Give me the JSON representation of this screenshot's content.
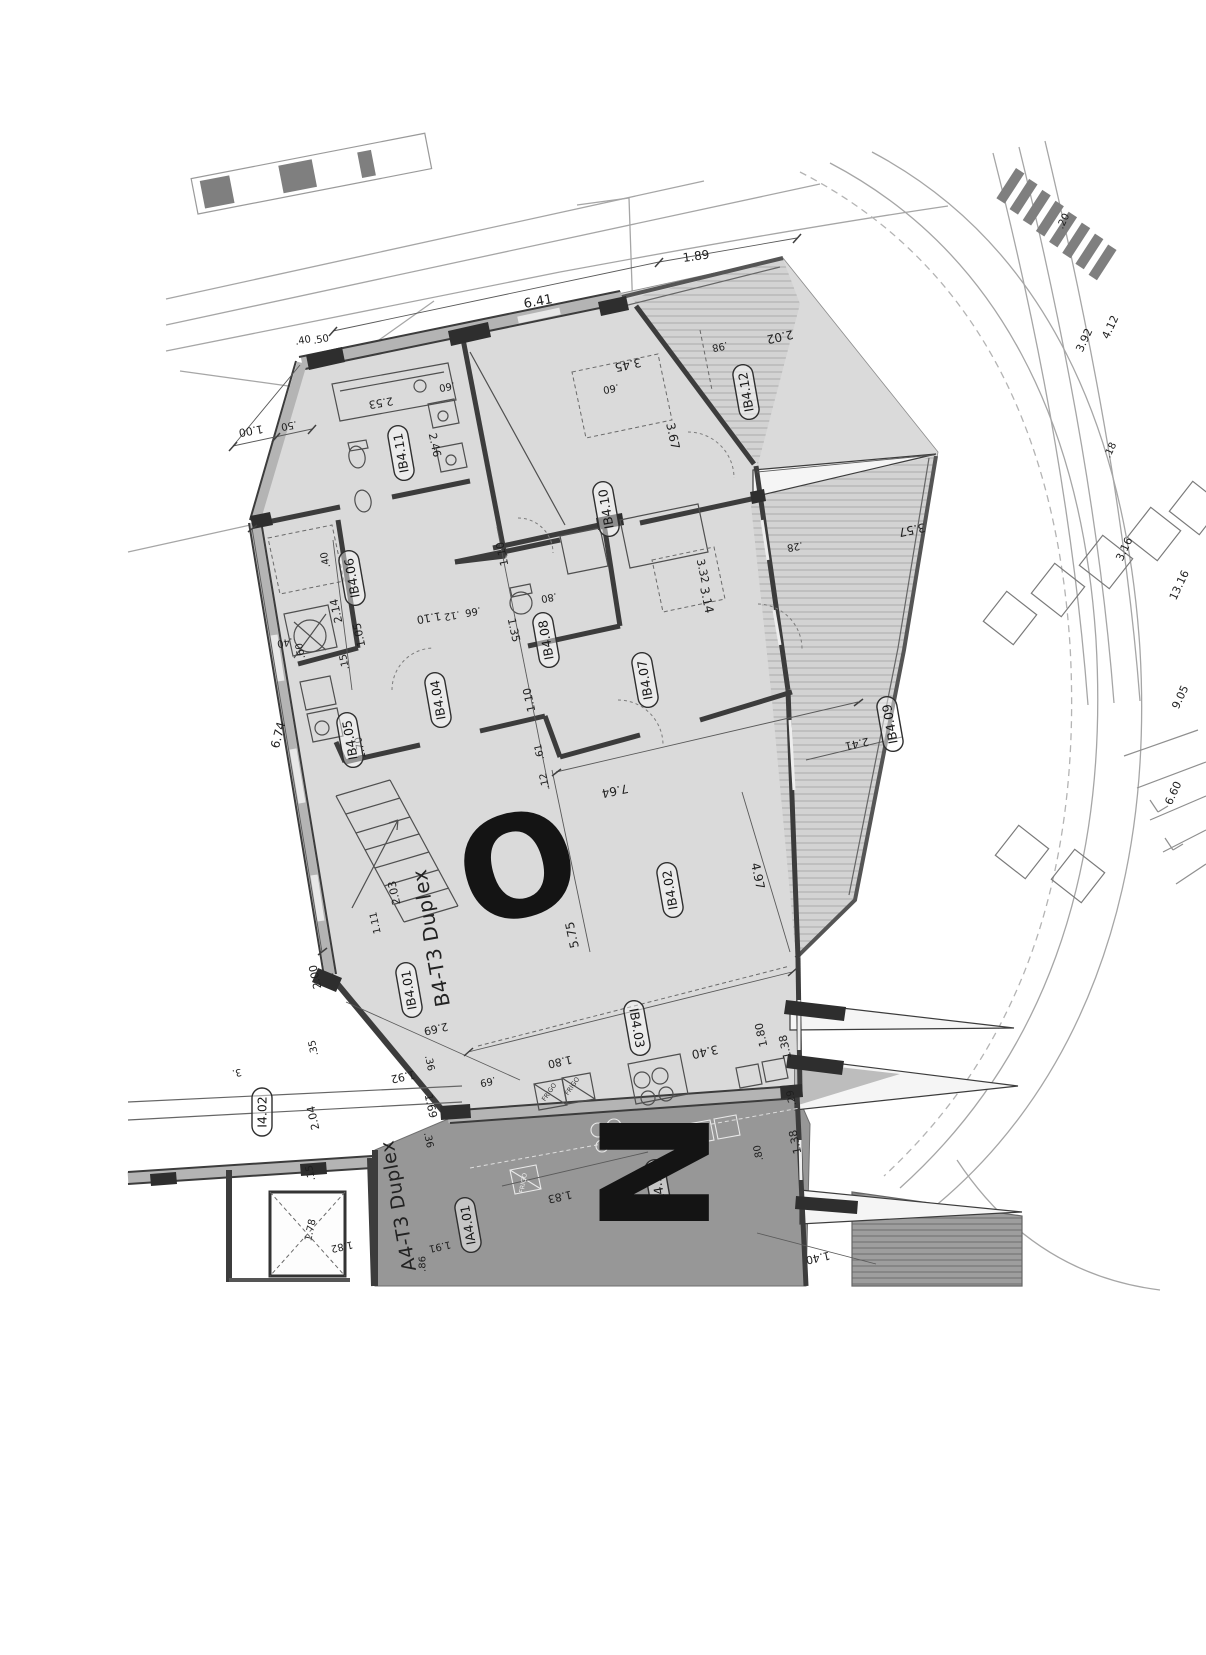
{
  "colors": {
    "paper": "#ffffff",
    "floor_fill": "#dadada",
    "dark_unit_fill": "#979797",
    "wall_ink": "#3c3c3c",
    "text_ink": "#1f1f1f"
  },
  "plan": {
    "titles": [
      "B4-T3 Duplex",
      "A4-T3 Duplex"
    ],
    "letters": [
      "O",
      "N"
    ],
    "rooms": [
      "IB4.11",
      "IB4.10",
      "IB4.12",
      "IB4.06",
      "IB4.08",
      "IB4.07",
      "IB4.04",
      "IB4.05",
      "IB4.09",
      "IB4.02",
      "IB4.01",
      "IB4.03",
      "I4.02",
      "IA4.01",
      "IA4.14"
    ],
    "appliances": [
      "FRIGO",
      "FRIGO",
      "FRIGO"
    ],
    "dims": [
      "6.41",
      "1.89",
      ".40",
      ".50",
      "1.00",
      ".50",
      "2.53",
      "2.46",
      ".60",
      ".60",
      "3.45",
      "3.67",
      "2.02",
      ".98",
      "1.10",
      "3.32",
      "3.14",
      ".40",
      "2.14",
      "1.05",
      ".40",
      ".60",
      ".15",
      "6.74",
      "1.10",
      ".12",
      ".66",
      "1.35",
      ".80",
      "1.10",
      ".61",
      ".12",
      "1.70",
      "7.64",
      "2.41",
      "3.57",
      ".28",
      "5.75",
      "4.97",
      "2.03",
      "1.11",
      "2.00",
      "2.69",
      ".35",
      "1.92",
      ".36",
      "1.69",
      ".36",
      ".69",
      "2.04",
      ".15",
      "3.",
      "1.78",
      "1.82",
      "1.91",
      ".86",
      "1.83",
      "1.80",
      "3.40",
      "1.80",
      "1.38",
      ".29",
      ".80",
      "1.38",
      "1.40"
    ],
    "site_dims": [
      ".20",
      "3.92",
      "4.12",
      ".18",
      "3.16",
      "13.16",
      "9.05",
      "6.60"
    ]
  }
}
